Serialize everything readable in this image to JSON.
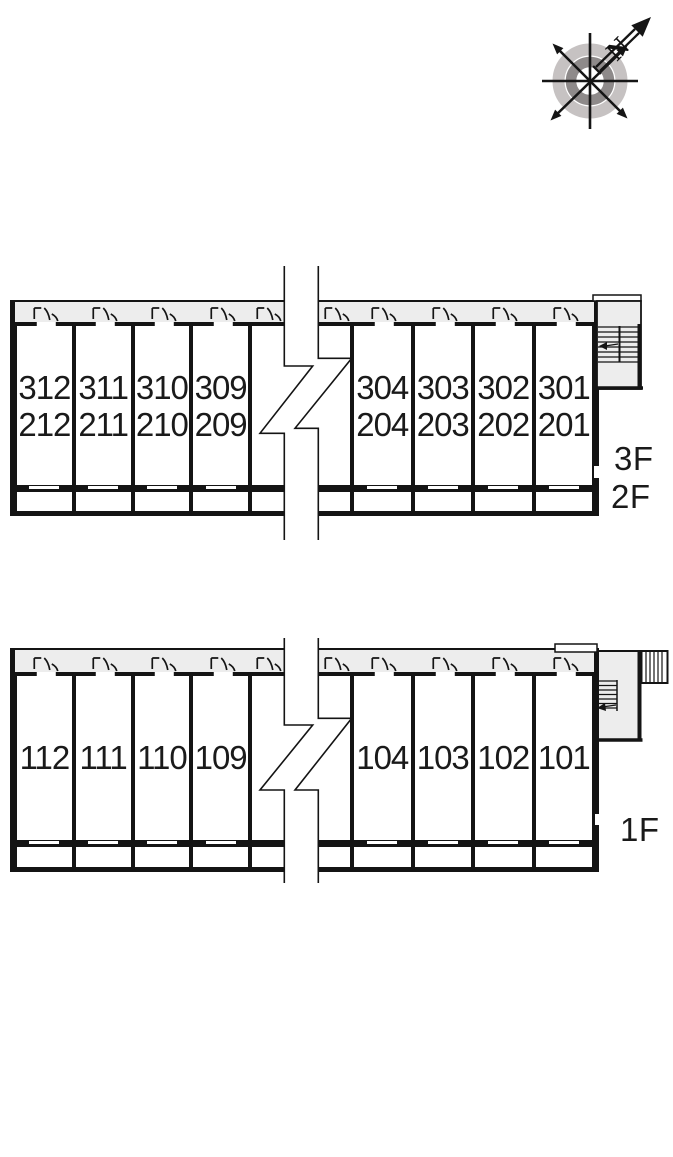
{
  "compass": {
    "north_label": "N"
  },
  "upper_building": {
    "floor_labels": {
      "upper": "3F",
      "lower": "2F"
    },
    "left_rooms": [
      {
        "top": "312",
        "bottom": "212"
      },
      {
        "top": "311",
        "bottom": "211"
      },
      {
        "top": "310",
        "bottom": "210"
      },
      {
        "top": "309",
        "bottom": "209"
      }
    ],
    "right_rooms": [
      {
        "top": "304",
        "bottom": "204"
      },
      {
        "top": "303",
        "bottom": "203"
      },
      {
        "top": "302",
        "bottom": "202"
      },
      {
        "top": "301",
        "bottom": "201"
      }
    ]
  },
  "lower_building": {
    "floor_label": "1F",
    "left_rooms": [
      {
        "number": "112"
      },
      {
        "number": "111"
      },
      {
        "number": "110"
      },
      {
        "number": "109"
      }
    ],
    "right_rooms": [
      {
        "number": "104"
      },
      {
        "number": "103"
      },
      {
        "number": "102"
      },
      {
        "number": "101"
      }
    ]
  },
  "colors": {
    "wall": "#141414",
    "corridor_fill": "#ededed",
    "compass_ring_light": "#c6c2c2",
    "compass_ring_dark": "#8e8a8a"
  }
}
